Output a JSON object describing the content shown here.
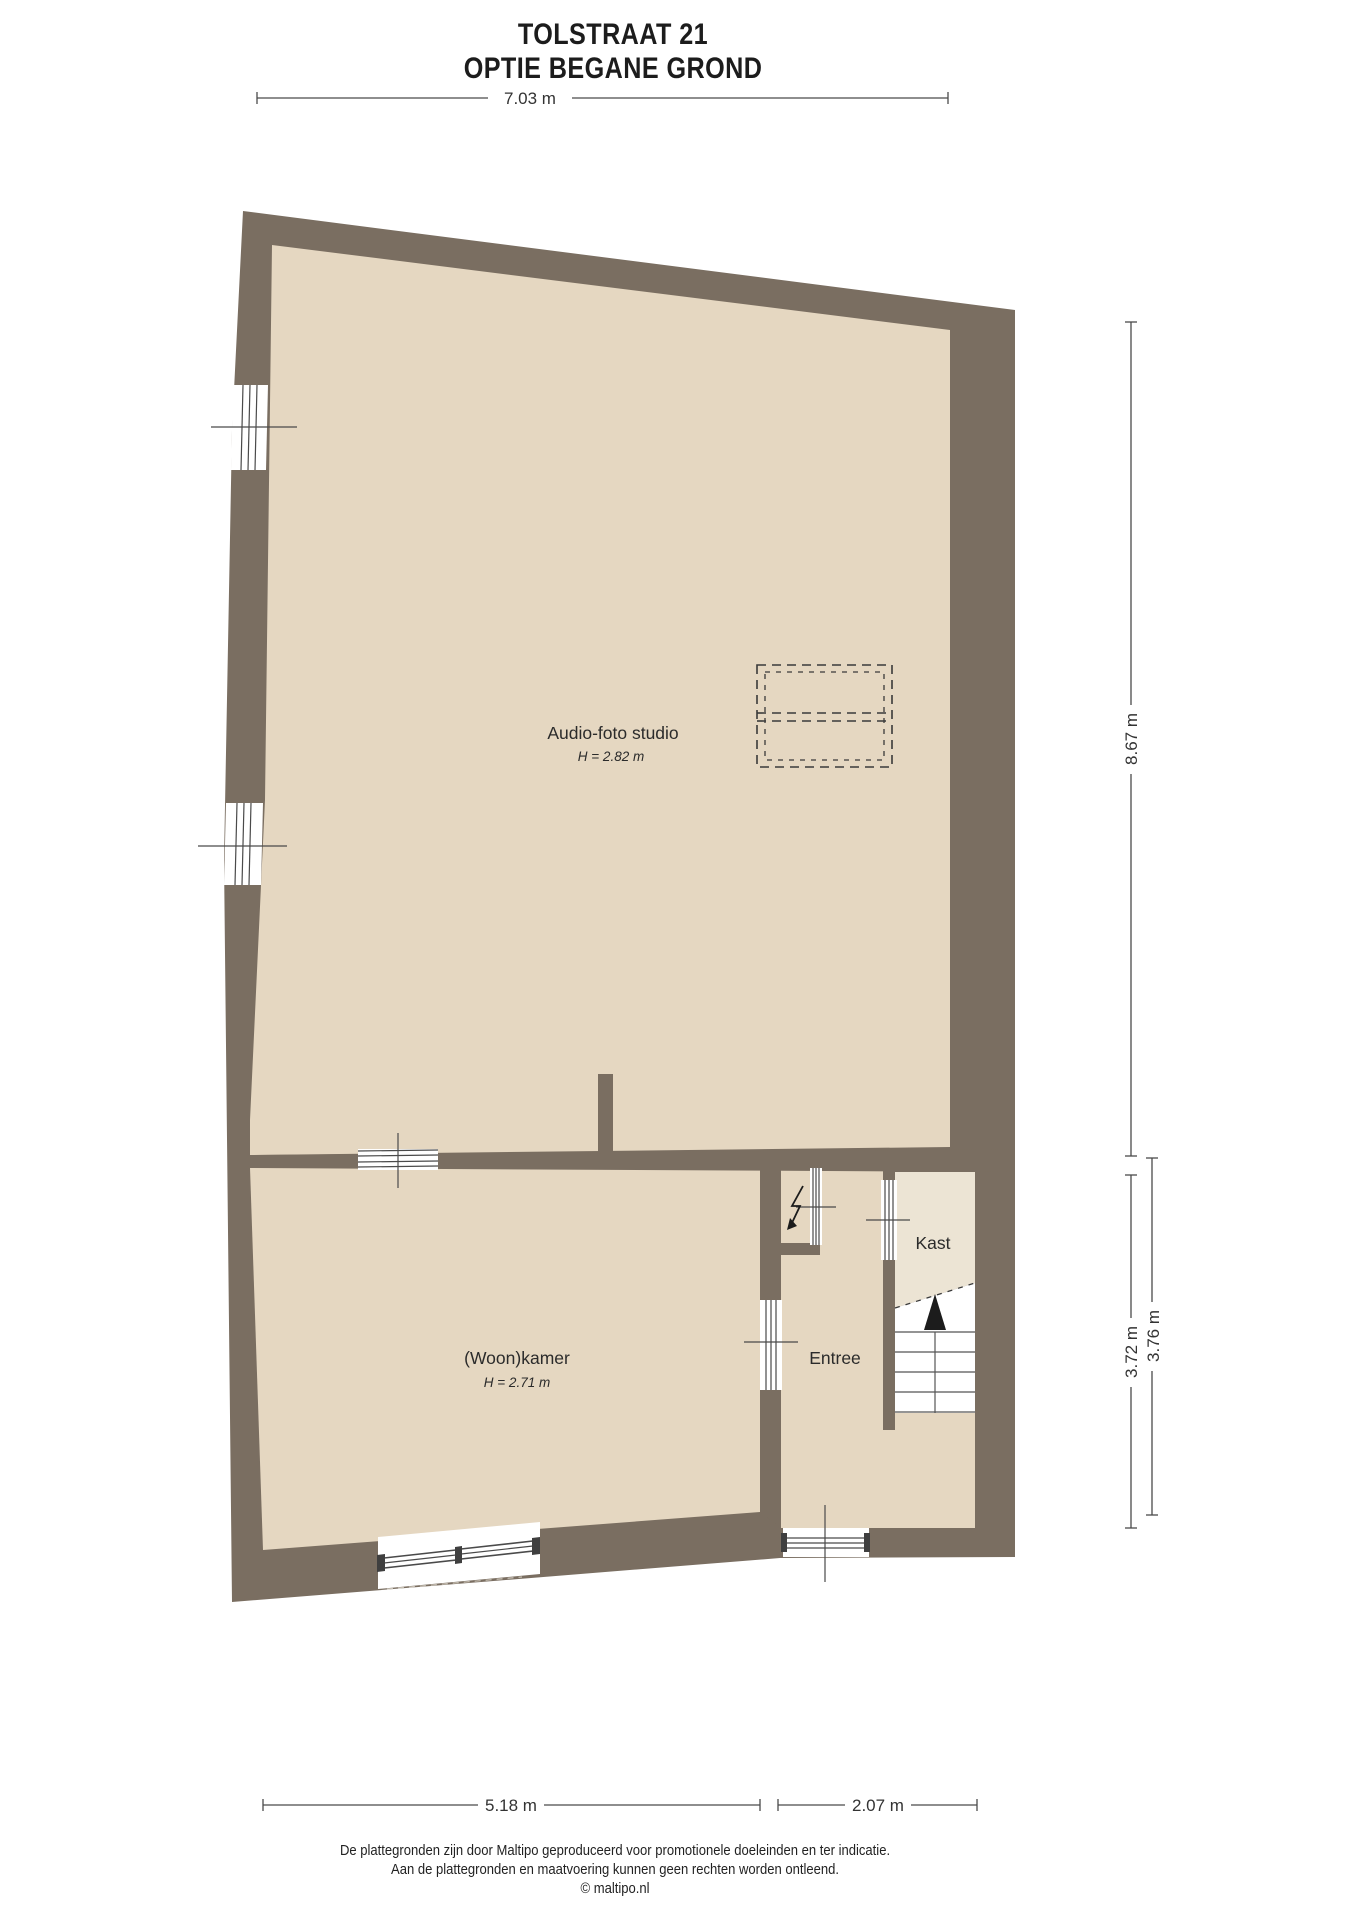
{
  "title": {
    "line1": "TOLSTRAAT 21",
    "line2": "OPTIE BEGANE GROND"
  },
  "rooms": [
    {
      "name": "Audio-foto studio",
      "height": "H = 2.82 m"
    },
    {
      "name": "(Woon)kamer",
      "height": "H = 2.71 m"
    },
    {
      "name": "Entree",
      "height": ""
    },
    {
      "name": "Kast",
      "height": ""
    }
  ],
  "dimensions": {
    "top_width": "7.03 m",
    "right_upper": "8.67 m",
    "right_lower_inner": "3.72 m",
    "right_lower_outer": "3.76 m",
    "bottom_left": "5.18 m",
    "bottom_right": "2.07 m"
  },
  "footer": {
    "line1": "De plattegronden zijn door Maltipo geproduceerd voor promotionele doeleinden en ter indicatie.",
    "line2": "Aan de plattegronden en maatvoering kunnen geen rechten worden ontleend.",
    "line3": "© maltipo.nl"
  },
  "icons": {
    "stair_direction": "up-arrow",
    "meter_cupboard": "lightning-bolt"
  },
  "colors": {
    "wall": "#7a6e61",
    "floor": "#e5d7c1",
    "kast_floor": "#ece4d4",
    "stairs": "#ffffff",
    "line": "#4a4a4a"
  }
}
